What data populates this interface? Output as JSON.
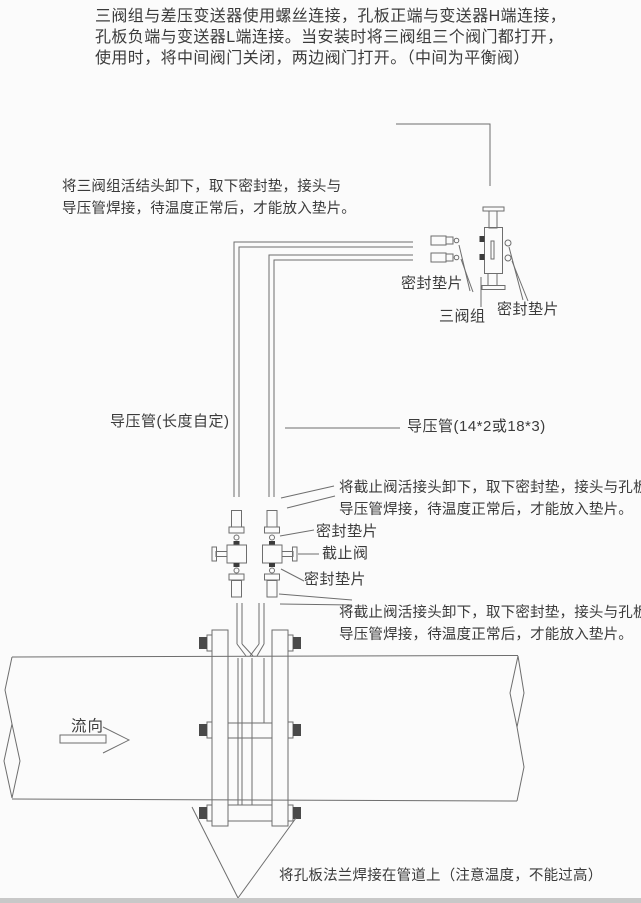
{
  "colors": {
    "ink": "#3b3b3b",
    "line": "#6e6e6e",
    "dark_fill": "#4a4a4a",
    "background": "#fbfbfb",
    "scan_edge": "#c8c8c8"
  },
  "notes": {
    "top": [
      "三阀组与差压变送器使用螺丝连接，孔板正端与变送器H端连接，",
      "孔板负端与变送器L端连接。当安装时将三阀组三个阀门都打开，",
      "使用时，将中间阀门关闭，两边阀门打开。（中间为平衡阀）"
    ],
    "manifold": [
      "将三阀组活结头卸下，取下密封垫，接头与",
      "导压管焊接，待温度正常后，才能放入垫片。"
    ],
    "valve_upper": [
      "将截止阀活接头卸下，取下密封垫，接头与孔板",
      "导压管焊接，待温度正常后，才能放入垫片。"
    ],
    "valve_lower": [
      "将截止阀活接头卸下，取下密封垫，接头与孔板",
      "导压管焊接，待温度正常后，才能放入垫片。"
    ],
    "bottom": "将孔板法兰焊接在管道上（注意温度，不能过高）"
  },
  "labels": {
    "gasket_left": "密封垫片",
    "manifold": "三阀组",
    "gasket_right": "密封垫片",
    "pipe_left": "导压管(长度自定)",
    "pipe_right": "导压管(14*2或18*3)",
    "gasket_upper": "密封垫片",
    "stop_valve": "截止阀",
    "gasket_lower": "密封垫片",
    "flow": "流向"
  }
}
